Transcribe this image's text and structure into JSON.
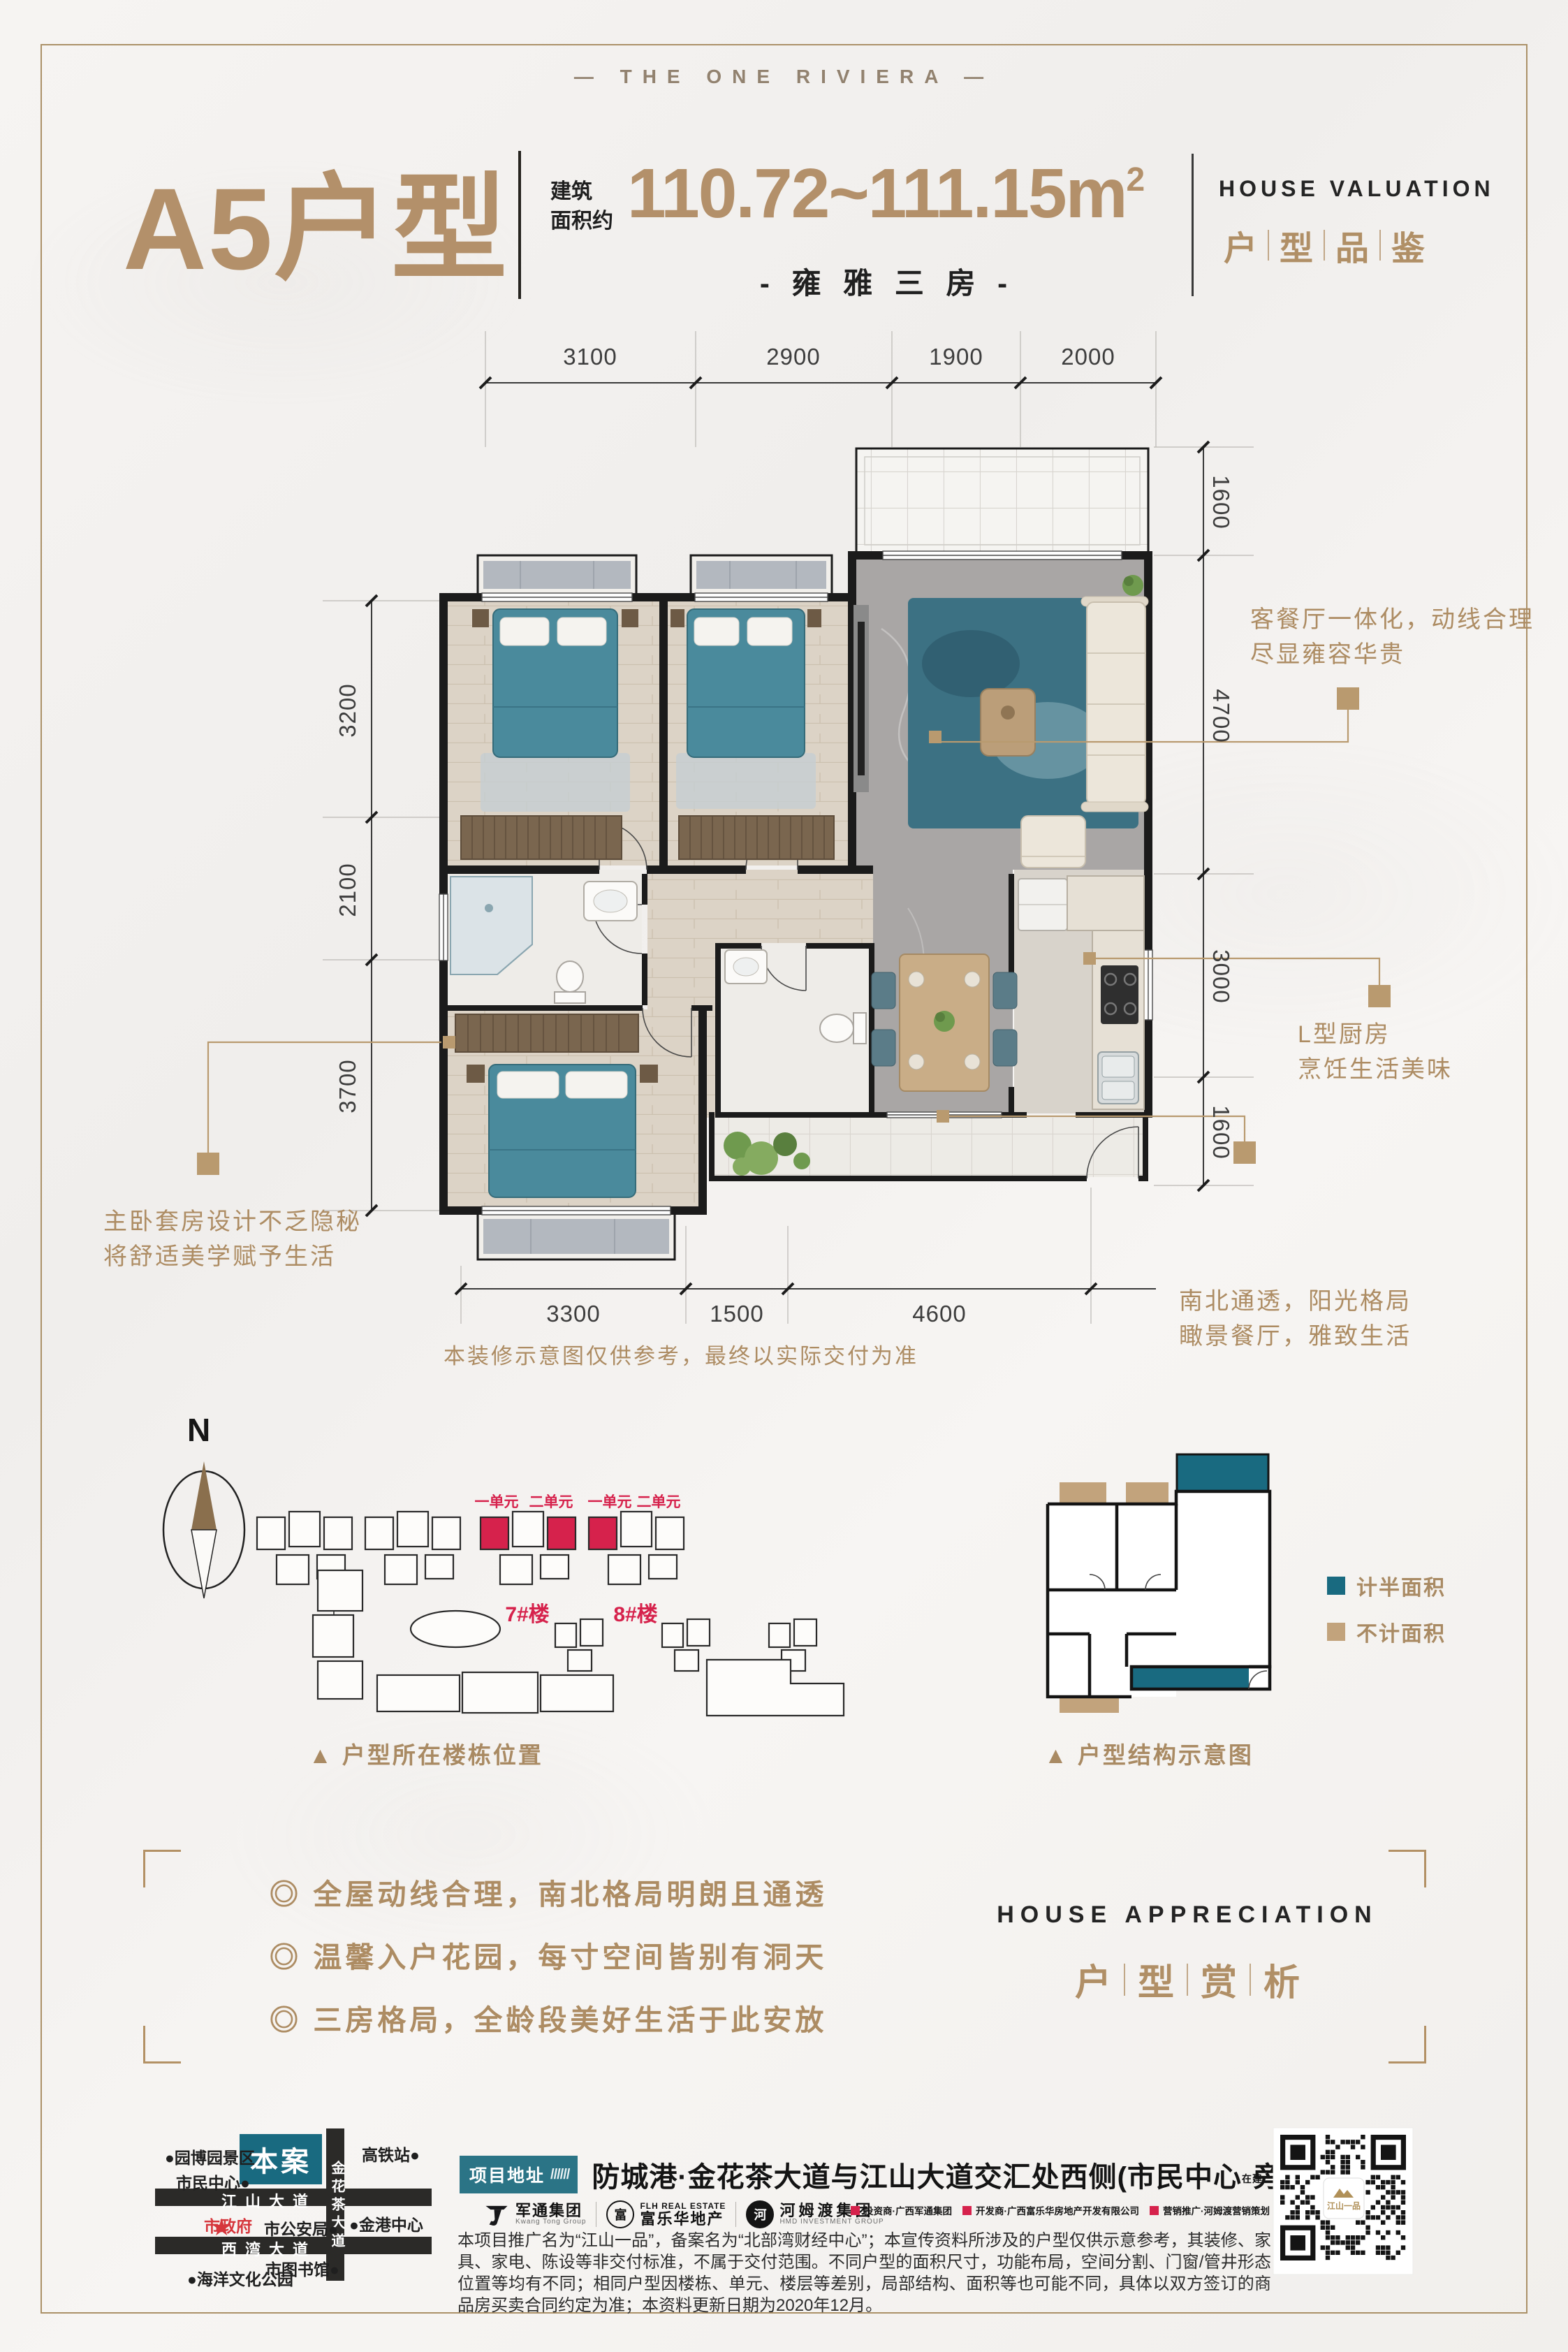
{
  "brand": {
    "wordmark": "— THE ONE RIVIERA —"
  },
  "header": {
    "unit_name": "A5户型",
    "area_label_line1": "建筑",
    "area_label_line2": "面积约",
    "area_value": "110.72~111.15m",
    "area_sup": "2",
    "subtitle": "- 雍 雅 三 房 -",
    "section_en": "HOUSE VALUATION",
    "section_cn": [
      "户",
      "型",
      "品",
      "鉴"
    ]
  },
  "plan": {
    "dims_top": [
      "3100",
      "2900",
      "1900",
      "2000"
    ],
    "dims_left": [
      "3200",
      "2100",
      "3700"
    ],
    "dims_right": [
      "1600",
      "4700",
      "3000",
      "1600"
    ],
    "dims_bottom": [
      "3300",
      "1500",
      "4600"
    ],
    "annotations": {
      "living": [
        "客餐厅一体化，动线合理",
        "尽显雍容华贵"
      ],
      "kitchen": [
        "L型厨房",
        "烹饪生活美味"
      ],
      "balcony": [
        "南北通透，阳光格局",
        "瞰景餐厅，雅致生活"
      ],
      "master": [
        "主卧套房设计不乏隐秘",
        "将舒适美学赋予生活"
      ]
    },
    "note": "本装修示意图仅供参考，最终以实际交付为准"
  },
  "site_plan": {
    "north_label": "N",
    "unit_labels_7": [
      "一单元",
      "二单元"
    ],
    "unit_labels_8": [
      "一单元",
      "二单元"
    ],
    "building_7": "7#楼",
    "building_8": "8#楼",
    "caption": "▲ 户型所在楼栋位置"
  },
  "structure": {
    "caption": "▲ 户型结构示意图",
    "legend_half": "计半面积",
    "legend_excluded": "不计面积"
  },
  "highlights": {
    "items": [
      "◎ 全屋动线合理，南北格局明朗且通透",
      "◎ 温馨入户花园，每寸空间皆别有洞天",
      "◎ 三房格局，全龄段美好生活于此安放"
    ],
    "section_en": "HOUSE APPRECIATION",
    "section_cn": [
      "户",
      "型",
      "赏",
      "析"
    ]
  },
  "footer": {
    "map": {
      "project": "本案",
      "road_v": "金花茶大道",
      "road_h1": "江山大道",
      "road_h2": "西湾大道",
      "poi_yuanbo": "●园博园景区",
      "poi_shimin": "市民中心●",
      "poi_gaotie": "高铁站●",
      "poi_jingang": "●金港中心",
      "poi_gongan": "市公安局●",
      "poi_tushuguan": "市图书馆●",
      "poi_haiyang": "●海洋文化公园",
      "poi_shizhengfu": "市政府"
    },
    "address_tag": "项目地址",
    "address_tag_slashes": "//////",
    "address_main": "防城港·金花茶大道与江山大道交汇处西侧(市民中心",
    "address_note": "在建",
    "address_tail": "旁)",
    "logo1_cn": "军通集团",
    "logo1_en": "Kwang Tong Group",
    "logo2_en": "FLH REAL ESTATE",
    "logo2_cn": "富乐华地产",
    "logo2_seal": "富",
    "logo3_cn": "河姆渡集团",
    "logo3_en": "HMD INVESTMENT GROUP",
    "logo3_seal": "河",
    "credit1": "投资商·广西军通集团",
    "credit2": "开发商·广西富乐华房地产开发有限公司",
    "credit3": "营销推广·河姆渡营销策划",
    "disclaimer": "本项目推广名为“江山一品”，备案名为“北部湾财经中心”；本宣传资料所涉及的户型仅供示意参考，其装修、家具、家电、陈设等非交付标准，不属于交付范围。不同户型的面积尺寸，功能布局，空间分割、门窗/管井形态位置等均有不同；相同户型因楼栋、单元、楼层等差别，局部结构、面积等也可能不同，具体以双方签订的商品房买卖合同约定为准；本资料更新日期为2020年12月。",
    "qr_label": "江山一品"
  }
}
